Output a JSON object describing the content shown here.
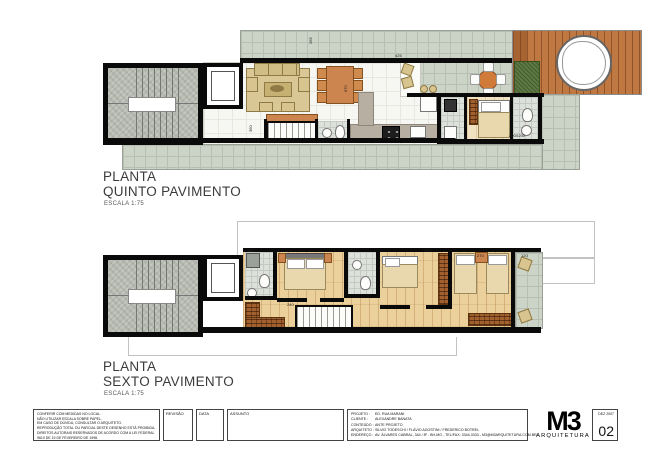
{
  "plan_quinto": {
    "title1": "PLANTA",
    "title2": "QUINTO PAVIMENTO",
    "scale": "ESCALA  1:75",
    "dims": [
      "425",
      "670",
      "265",
      "360",
      "200X200"
    ]
  },
  "plan_sexto": {
    "title1": "PLANTA",
    "title2": "SEXTO PAVIMENTO",
    "scale": "ESCALA  1:75",
    "dims": [
      "325",
      "270",
      "120",
      "240",
      "150"
    ]
  },
  "titleblock": {
    "notes": [
      "CONFERIR COM MEDIDAS NO LOCAL.",
      "NÃO UTILIZAR ESCALA SOBRE PAPEL.",
      "EM CASO DE DÚVIDA, CONSULTAR O ARQUITETO.",
      "REPRODUÇÃO TOTAL OU PARCIAL DESTE DESENHO ESTÁ PROIBIDA.",
      "DIREITOS AUTORAIS RESERVADOS DE ACORDO COM A LEI FEDERAL",
      "9610 DE 19 DE FEVEREIRO DE 1998."
    ],
    "revisao_label": "REVISÃO",
    "data_label": "DATA",
    "assunto_label": "ASSUNTO",
    "info": {
      "projeto_label": "PROJETO :",
      "projeto": "ED. RUA MARANI",
      "cliente_label": "CLIENTE :",
      "cliente": "ALEXANDRE BANATA",
      "conteudo_label": "CONTEÚDO :",
      "conteudo": "ANTE PROJETO",
      "arquiteto_label": "ARQUITETO :",
      "arquiteto": "SILVIO TODESCHI / FLÁVIO AGOSTINI / FREDERICO BOTREL",
      "endereco_label": "ENDEREÇO :",
      "endereco": "AV. ÁLVARES CABRAL, 344 / 8º - BH-MG - TEL/FAX: 3344-3333 - M3@M3ARQUITETURA.COM.BR"
    },
    "logo_mark": "M3",
    "logo_name": "ARQUITETURA",
    "sheet_date": "DEZ 2007",
    "sheet_number": "02"
  },
  "colors": {
    "tile": "#ccd3c7",
    "deck": "#c07843",
    "wood_floor": "#ecd09c",
    "wall": "#0a0a0a",
    "planter_green": "#5d7a42",
    "furniture_tan": "#d8c48e",
    "furniture_wood": "#cd8550"
  }
}
